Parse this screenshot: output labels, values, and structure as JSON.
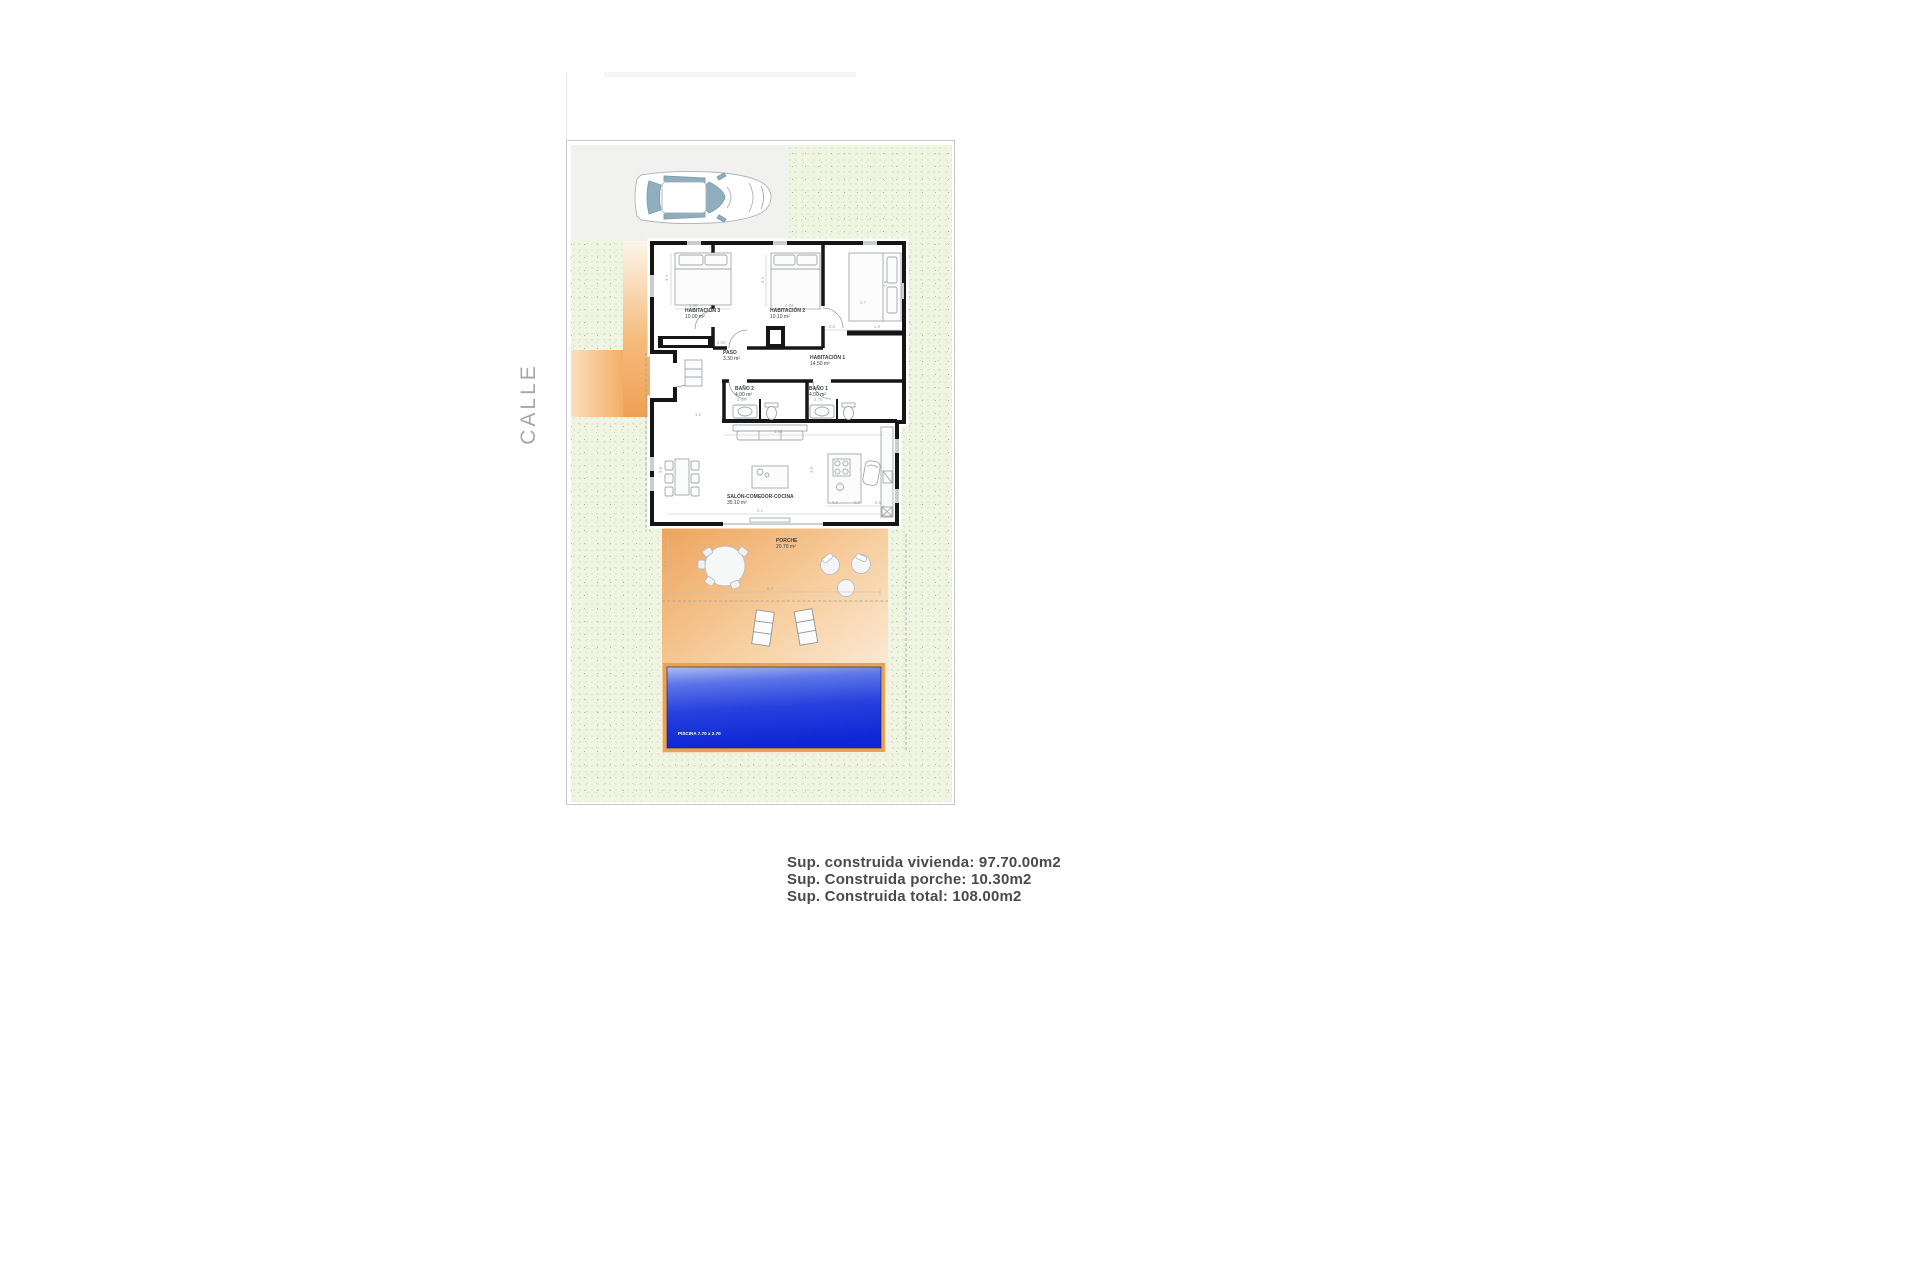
{
  "street_label": "CALLE",
  "plan": {
    "rooms": {
      "hab3": {
        "name": "HABITACIÓN 3",
        "area": "10.00 m²"
      },
      "hab2": {
        "name": "HABITACIÓN 2",
        "area": "10.10 m²"
      },
      "hab1": {
        "name": "HABITACIÓN 1",
        "area": "14.50 m²"
      },
      "paso": {
        "name": "PASO",
        "area": "3.30 m²"
      },
      "bano2": {
        "name": "BAÑO 2",
        "area": "4.00 m²"
      },
      "bano1": {
        "name": "BAÑO 1",
        "area": "4.00 m²"
      },
      "salon": {
        "name": "SALÓN-COMEDOR-COCINA",
        "area": "35.10 m²"
      },
      "porche": {
        "name": "PORCHE",
        "area": "20.70 m²"
      }
    },
    "pool_label": "PISCINA 7.70 x 2.70",
    "dimensions": {
      "d1": "2.86",
      "d2": "3.4",
      "d3": "2.84",
      "d4": "3.4",
      "d5": "2.7",
      "d6": "2.8",
      "d7": "6.8",
      "d8": "1.8",
      "d9": "2.02",
      "d10": "1.6",
      "d11": "2.65",
      "d12": "2.75",
      "d13": "6.95",
      "d14": "5.1",
      "d15": "3.8",
      "d16": "3.8",
      "d17": "0.9",
      "d18": "0.9",
      "d19": "0.8",
      "d20": "8.2",
      "d21": "1.7"
    }
  },
  "summary": {
    "line1": "Sup. construida vivienda: 97.70.00m2",
    "line2": "Sup. Construida porche: 10.30m2",
    "line3": "Sup. Construida total: 108.00m2"
  },
  "colors": {
    "accent_orange": "#efa055",
    "pool_blue": "#1c35d8",
    "pool_frame": "#e9a153",
    "garden_green": "#f0f4e2",
    "wall_black": "#161616"
  }
}
